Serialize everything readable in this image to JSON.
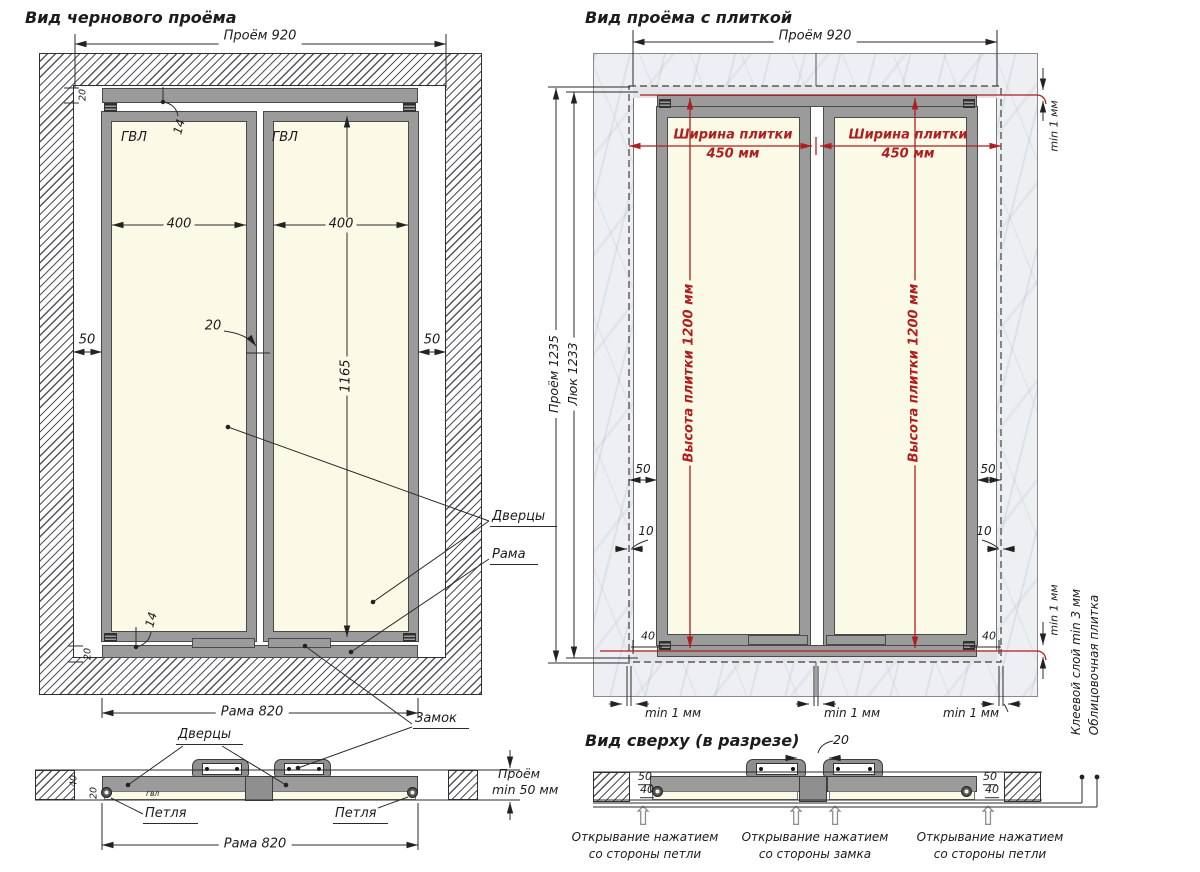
{
  "colors": {
    "accent_red": "#b01f1f",
    "hatch_fill": "#54555a",
    "panel_cream": "#fbfae6",
    "frame_gray": "#9b9b9b",
    "tile_gray": "#edeff2"
  },
  "icons": {
    "press_open_arrow": "⇧"
  },
  "left_view": {
    "title": "Вид чернового проёма",
    "dim_opening_width": "Проём 920",
    "material": "ГВЛ",
    "dim_door_width": "400",
    "dim_door_height": "1165",
    "dim_side_gap": "50",
    "dim_center_gap": "20",
    "dim_panel_gap": "14",
    "dim_frame_profile": "20",
    "dim_frame_width": "Рама 820",
    "label_doors": "Дверцы",
    "label_frame": "Рама",
    "label_lock": "Замок"
  },
  "left_section": {
    "label_doors": "Дверцы",
    "label_hinge": "Петля",
    "dim_frame_width": "Рама 820",
    "depth_line1": "Проём",
    "depth_line2": "min 50 мм",
    "material": "гвл",
    "dim_door_thickness": "40",
    "dim_panel_thickness": "20"
  },
  "right_view": {
    "title": "Вид проёма с плиткой",
    "dim_opening_width": "Проём 920",
    "tile_width_line1": "Ширина плитки",
    "tile_width_line2": "450 мм",
    "tile_height": "Высота плитки 1200 мм",
    "dim_opening_height": "Проём 1235",
    "dim_hatch_height": "Люк 1233",
    "dim_side_gap": "50",
    "dim_tile_overlap": "10",
    "dim_bottom_gap": "40",
    "min_gap": "min 1 мм"
  },
  "right_section": {
    "title": "Вид сверху (в разрезе)",
    "dim_center_gap": "20",
    "dim_frame_depth": "50",
    "dim_door_depth": "40",
    "captions": [
      {
        "line1": "Открывание нажатием",
        "line2": "со стороны петли"
      },
      {
        "line1": "Открывание нажатием",
        "line2": "со стороны замка"
      },
      {
        "line1": "Открывание нажатием",
        "line2": "со стороны петли"
      }
    ],
    "callout_glue": "Клеевой слой min 3 мм",
    "callout_tile": "Облицовочная плитка"
  }
}
